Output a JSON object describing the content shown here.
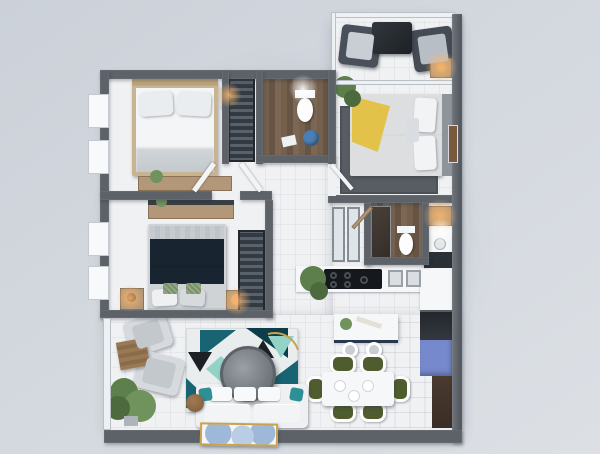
{
  "scene": {
    "type": "3d-floor-plan-render",
    "description": "Top-down 3D render of a two-bedroom apartment with balcony, two bathrooms, kitchen, dining and living area",
    "rooms": [
      {
        "name": "bedroom-1",
        "furniture": [
          "white-double-bed",
          "nightstand-with-clock",
          "dresser-with-plant",
          "two-windows"
        ]
      },
      {
        "name": "hall-closet",
        "furniture": [
          "wardrobe-with-clothes"
        ]
      },
      {
        "name": "bathroom-1",
        "furniture": [
          "toilet",
          "laundry-bin",
          "towel"
        ]
      },
      {
        "name": "balcony",
        "furniture": [
          "armchair",
          "armchair",
          "dark-coffee-table"
        ]
      },
      {
        "name": "master-bedroom",
        "furniture": [
          "bed-with-yellow-throw",
          "dark-area-rug",
          "nightstand-lamp",
          "nook-nightstand-lamp",
          "potted-plant",
          "wall-art"
        ]
      },
      {
        "name": "bedroom-2",
        "furniture": [
          "navy-double-bed",
          "desk",
          "wardrobe-with-clothes",
          "nightstand-lamp-left",
          "nightstand-lamp-right",
          "two-windows"
        ]
      },
      {
        "name": "bathroom-2",
        "furniture": [
          "shower",
          "toilet",
          "vanity-sink",
          "glass-partitions"
        ]
      },
      {
        "name": "kitchen",
        "furniture": [
          "cooktop",
          "double-sink",
          "island-with-two-stools",
          "fridge-blue",
          "oven",
          "sideboard",
          "potted-plant"
        ]
      },
      {
        "name": "dining-area",
        "furniture": [
          "white-table",
          "six-olive-chairs",
          "plates"
        ]
      },
      {
        "name": "living-room",
        "furniture": [
          "white-sofa",
          "teal-geometric-rug",
          "round-ottoman",
          "arc-floor-lamp",
          "two-gray-armchairs",
          "wood-side-table",
          "floor-plant",
          "art-doormat"
        ]
      }
    ]
  },
  "palette": {
    "bg-a": "#ccd1d9",
    "bg-b": "#dce0e5",
    "wall": "#5d6269",
    "floor": "#f0f1f3",
    "wood": "#b29778",
    "wardrobe-dark": "#333a42",
    "navy": "#18242f",
    "teal": "#186472",
    "teal-dark": "#0d3d49",
    "mint": "#93d2c7",
    "black-accent": "#1c1f24",
    "olive": "#4e5c2e",
    "fridge-blue": "#7689cc",
    "white-furn": "#f6f7f8",
    "gray-furn": "#c9ced3",
    "charcoal": "#2c3137",
    "gold": "#c9a24b",
    "sofa-teal": "#2e8f96",
    "throw-yellow": "#e3c24a",
    "mat-blue": "#9db8d8",
    "plant": "#5d7f4c",
    "glow-warm": "#fab76c"
  }
}
